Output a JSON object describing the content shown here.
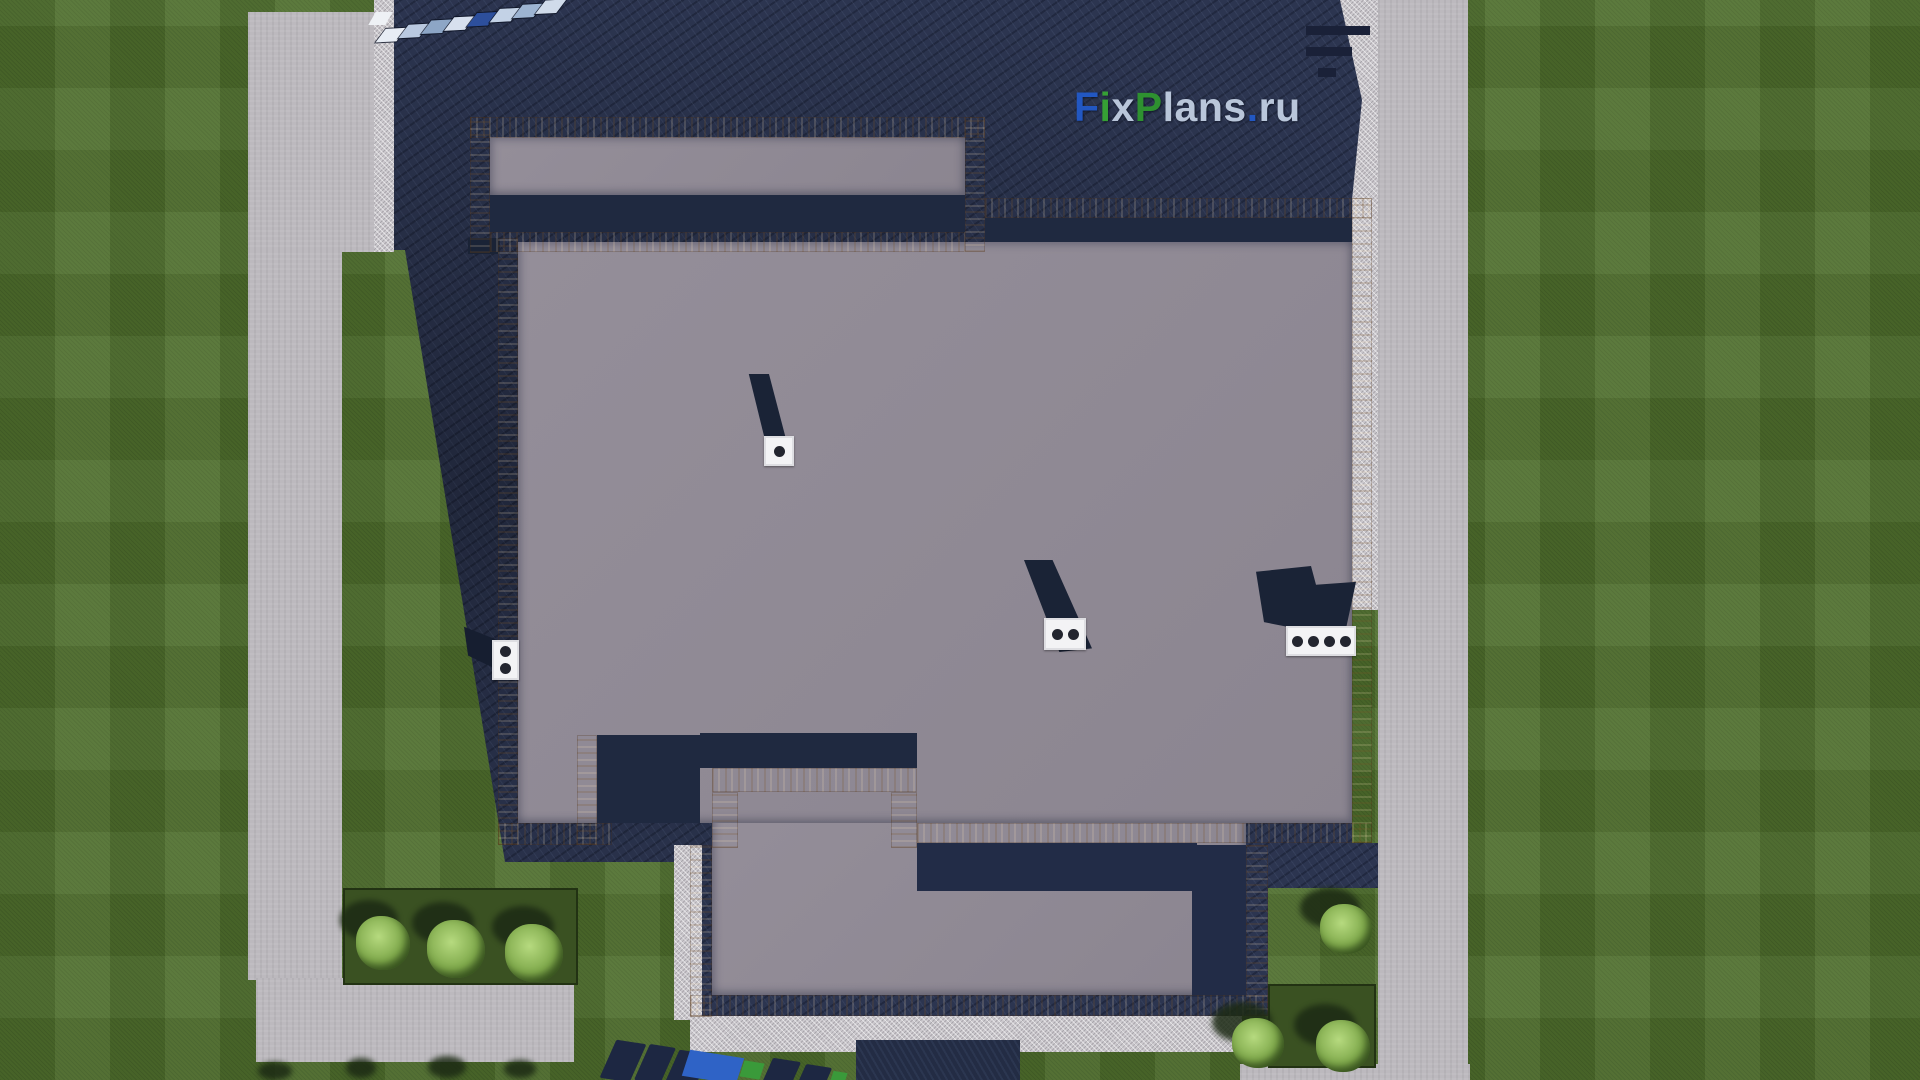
{
  "watermark": {
    "text": "FixPlans.ru",
    "letters": [
      {
        "char": "F",
        "color": "#2257c2"
      },
      {
        "char": "i",
        "color": "#36a035"
      },
      {
        "char": "x",
        "color": "#b9c6da"
      },
      {
        "char": "P",
        "color": "#2e9130"
      },
      {
        "char": "l",
        "color": "#b9c6da"
      },
      {
        "char": "a",
        "color": "#b9c6da"
      },
      {
        "char": "n",
        "color": "#b9c6da"
      },
      {
        "char": "s",
        "color": "#b9c6da"
      },
      {
        "char": ".",
        "color": "#2257c2"
      },
      {
        "char": "r",
        "color": "#b9c6da"
      },
      {
        "char": "u",
        "color": "#b9c6da"
      }
    ]
  },
  "scene": {
    "type": "aerial-site-plan-render",
    "palette": {
      "lawn": "#50702e",
      "planting_bed": "#3a5122",
      "bush": "#8fbf5e",
      "concrete_path": "#bcb9be",
      "gravel_apron": "#cbc8cd",
      "house_shadow": "#2c3550",
      "roof_gray": "#8f8993",
      "wood_parapet": "#d0a269",
      "vent_cap_white": "#f3f3f5",
      "vent_shadow": "#1a2336"
    },
    "roof_vents": [
      {
        "id": "vent-1",
        "holes": 1
      },
      {
        "id": "vent-2",
        "holes": 2
      },
      {
        "id": "vent-3",
        "holes": 4
      },
      {
        "id": "vent-left",
        "holes": 2
      }
    ],
    "driveway_panels": {
      "colors": [
        "#e8edf5",
        "#b9c9e0",
        "#8da6c6",
        "#d7e0ee",
        "#2d4f9c",
        "#c3d2e6",
        "#9db4d2",
        "#d0dbea"
      ]
    },
    "bushes": {
      "bottom_left_count": 3,
      "right_side_count": 3
    },
    "entry_steps_count": 3
  }
}
